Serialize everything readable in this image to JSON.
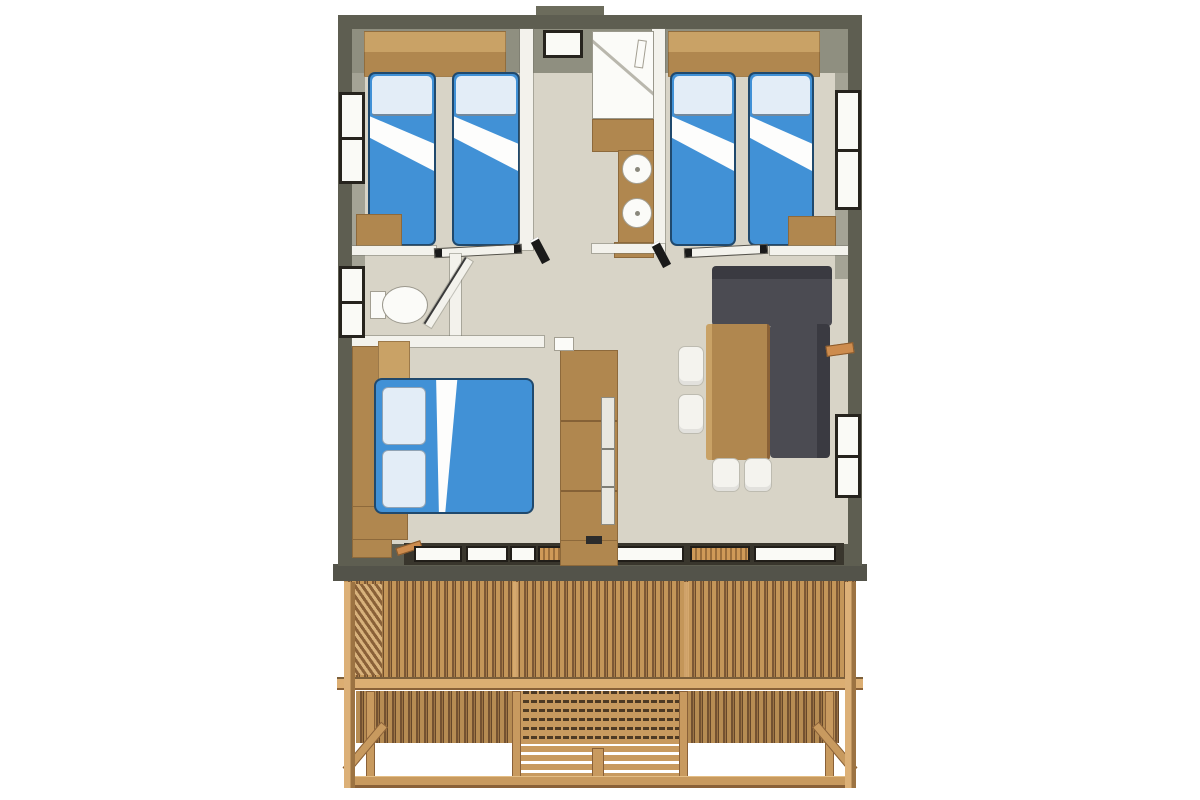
{
  "scene": {
    "type": "floor-plan-illustration",
    "subject": "Top-down 3D floor plan of a wooden stilted lodge with slatted deck base and central stairs",
    "text_visible": "none"
  },
  "rooms": [
    {
      "name": "twin-bedroom-left",
      "furniture": [
        "single-bed",
        "single-bed",
        "overhead-storage",
        "bench"
      ]
    },
    {
      "name": "shower-room-center",
      "furniture": [
        "shower-cabin",
        "washbasin",
        "washbasin",
        "vanity-counter"
      ]
    },
    {
      "name": "twin-bedroom-right",
      "furniture": [
        "single-bed",
        "single-bed",
        "overhead-storage",
        "bench"
      ]
    },
    {
      "name": "wc",
      "furniture": [
        "toilet"
      ]
    },
    {
      "name": "master-bedroom",
      "furniture": [
        "double-bed",
        "wardrobe",
        "bedside-bench"
      ]
    },
    {
      "name": "kitchen",
      "furniture": [
        "tall-kitchen-unit",
        "appliance-front"
      ]
    },
    {
      "name": "living-dining",
      "furniture": [
        "corner-sofa",
        "dining-table",
        "chair",
        "chair",
        "chair",
        "chair",
        "wall-shelf"
      ]
    }
  ],
  "openings": {
    "side_windows": 4,
    "top_window": 1,
    "sliding_bay_windows": 2,
    "sliding_doors": 2,
    "hinged_doors": 1
  },
  "deck": {
    "elements": [
      "fascia",
      "slatted-fence",
      "louver-panel",
      "handrail",
      "lower-slat-panels",
      "lattice-panel",
      "staircase",
      "stilt-frame",
      "diagonal-braces",
      "ground-beam"
    ]
  },
  "colors": {
    "wall_dark": "#5e5e51",
    "wall_top": "#6c6c5c",
    "wall_inner": "#8f8f80",
    "partition_white": "#f3f2ec",
    "floor": "#d8d4c7",
    "bed_blue": "#4191d6",
    "pillow_blue": "#e3edf7",
    "fold_white": "#fdfdfc",
    "wood": "#b0874f",
    "wood_light": "#c9a266",
    "wood_dark": "#8a6136",
    "sofa_gray": "#4b4b52",
    "sofa_gray_dark": "#3a3a41",
    "chair_white": "#f4f3ee",
    "fixture_white": "#fbfbf8",
    "fixture_border": "#a39f92",
    "window_frame": "#26231d",
    "window_pane": "#fafaf6",
    "glazing_band": "#39362d",
    "glazing_frame": "#211e19",
    "deck_fascia": "#53534a",
    "deck_wood": "#c89a5f",
    "deck_wood_light": "#dcae72",
    "deck_wood_dark": "#8a6138",
    "deck_slat_dark": "#7d5835",
    "lattice_dark": "#4e3a24",
    "accent_orange": "#cd8c4e"
  }
}
